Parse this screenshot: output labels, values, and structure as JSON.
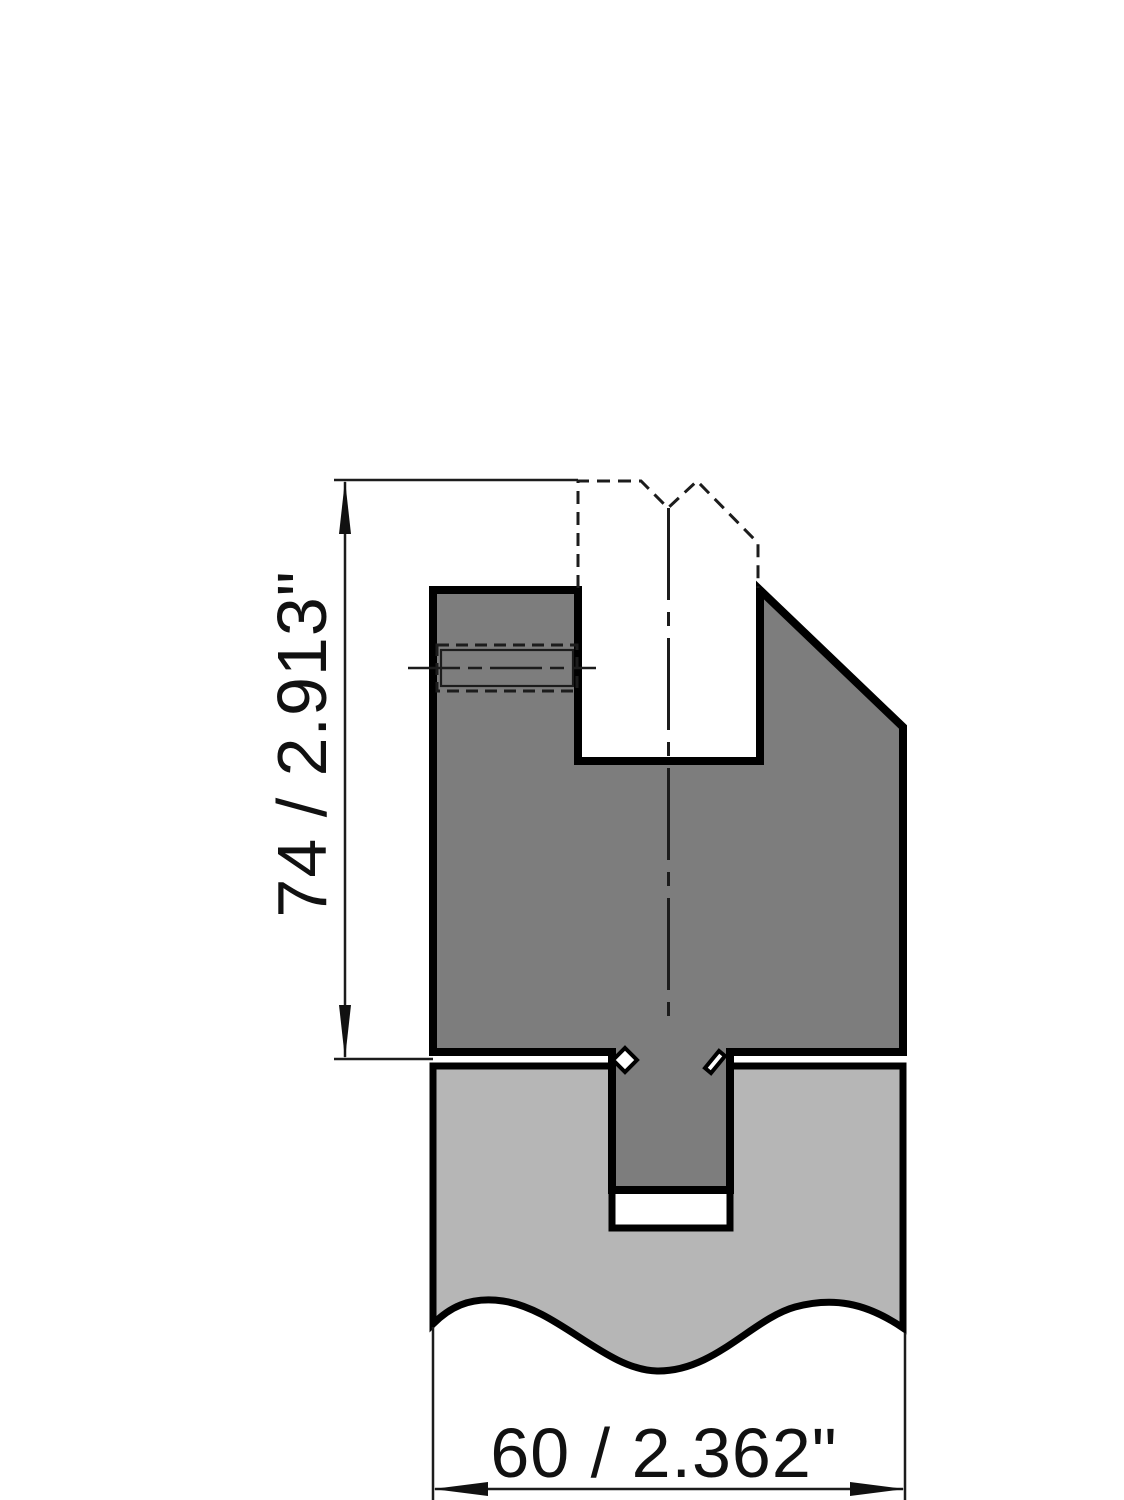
{
  "dimensions": {
    "height_label": "74 / 2.913\"",
    "width_label": "60 / 2.362\""
  },
  "colors": {
    "background": "#ffffff",
    "outline": "#000000",
    "tool_fill": "#7d7d7d",
    "base_fill": "#b6b6b6",
    "annotation": "#1c1c1c",
    "text": "#111111"
  }
}
